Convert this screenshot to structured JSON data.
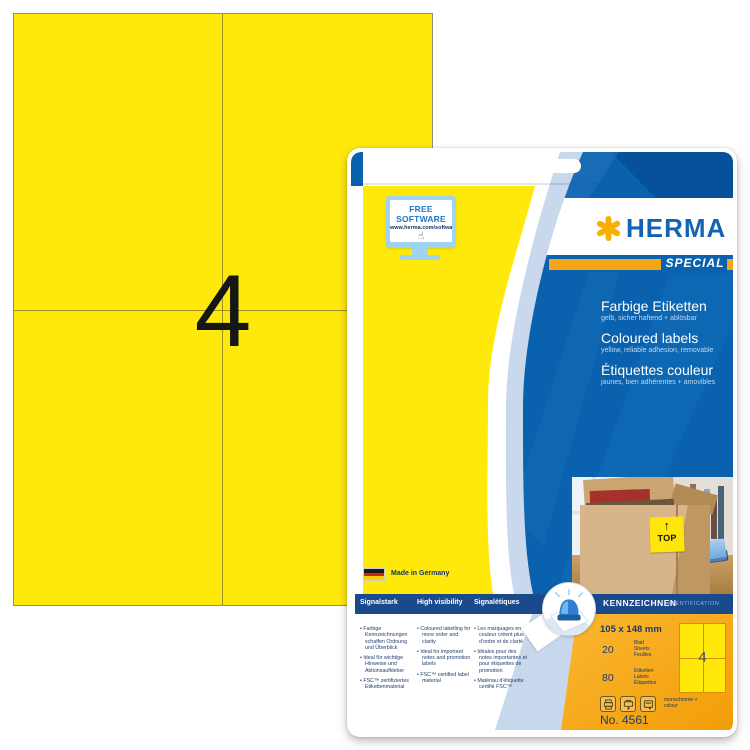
{
  "product": {
    "sheet": {
      "count": "4"
    },
    "badge": {
      "title": "FREE SOFTWARE",
      "url": "www.herma.com/software"
    },
    "brand": {
      "name": "HERMA",
      "edition": "SPECIAL"
    },
    "titles": [
      {
        "title": "Farbige Etiketten",
        "subtitle": "gelb, sicher haftend + ablösbar"
      },
      {
        "title": "Coloured labels",
        "subtitle": "yellow, reliable adhesion, removable"
      },
      {
        "title": "Étiquettes couleur",
        "subtitle": "jaunes, bien adhérentes + amovibles"
      }
    ],
    "photo": {
      "label": "TOP"
    },
    "made_in": "Made in Germany",
    "columns": [
      {
        "header": "Signalstark",
        "bullets": [
          "Farbige Kennzeichnungen schaffen Ordnung und Überblick",
          "Ideal für wichtige Hinweise und Aktionsaufkleber",
          "FSC™ zertifiziertes Etikettenmaterial"
        ]
      },
      {
        "header": "High visibility",
        "bullets": [
          "Coloured labelling for more order and clarity",
          "Ideal for important notes and promotion labels",
          "FSC™ certified label material"
        ]
      },
      {
        "header": "Signalétiques",
        "bullets": [
          "Les marquages en couleur créent plus d'ordre et de clarté",
          "Idéales pour des notes importantes et pour étiquettes de promotion",
          "Matériau d'étiquette certifié FSC™"
        ]
      }
    ],
    "category": {
      "title": "KENNZEICHNEN",
      "subtitle": "IDENTIFICATION"
    },
    "specs": {
      "size": "105 x 148 mm",
      "sheets": {
        "count": "20",
        "units": [
          "Blatt",
          "Sheets",
          "Feuilles"
        ]
      },
      "labels": {
        "count": "80",
        "units": [
          "Etiketten",
          "Labels",
          "Étiquettes"
        ]
      },
      "print": "monochrome + colour",
      "order_no": "No. 4561",
      "diagram_count": "4"
    },
    "colors": {
      "label_yellow": "#FFE90B",
      "herma_blue": "#1464B4",
      "card_blue": "#0A61AD",
      "navy_bar": "#1A4A8C",
      "orange": "#F6A519"
    }
  }
}
